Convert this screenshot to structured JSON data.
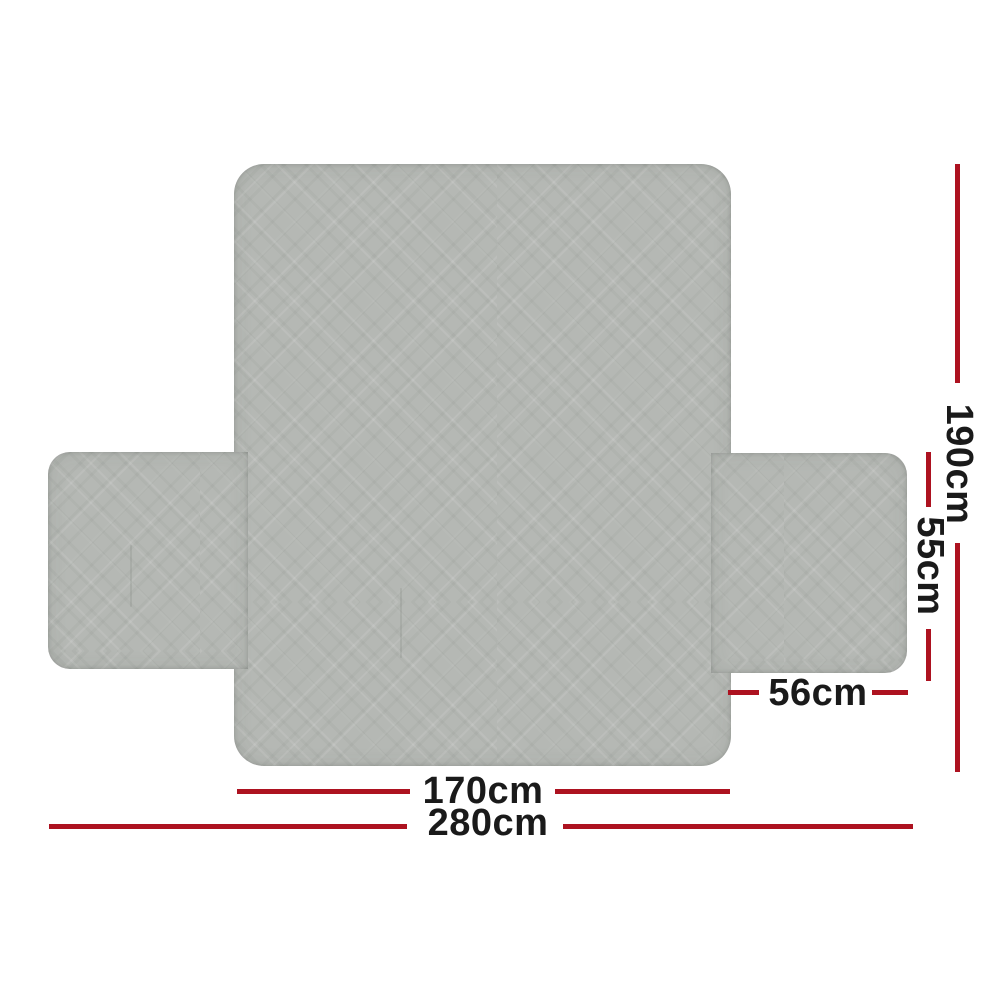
{
  "diagram": {
    "type": "product-dimension-diagram",
    "product": "quilted sofa cover laid flat (back panel with two arm flaps)",
    "dimensions": [
      {
        "id": "total-height",
        "label": "190cm",
        "orientation": "vertical"
      },
      {
        "id": "flap-height",
        "label": "55cm",
        "orientation": "vertical"
      },
      {
        "id": "flap-width",
        "label": "56cm",
        "orientation": "horizontal"
      },
      {
        "id": "panel-width",
        "label": "170cm",
        "orientation": "horizontal"
      },
      {
        "id": "total-width",
        "label": "280cm",
        "orientation": "horizontal"
      }
    ],
    "colors": {
      "dimension_line": "#ad1220",
      "label_text": "#1a1a1a",
      "fabric": "#b5b8b4",
      "background": "#ffffff"
    }
  }
}
